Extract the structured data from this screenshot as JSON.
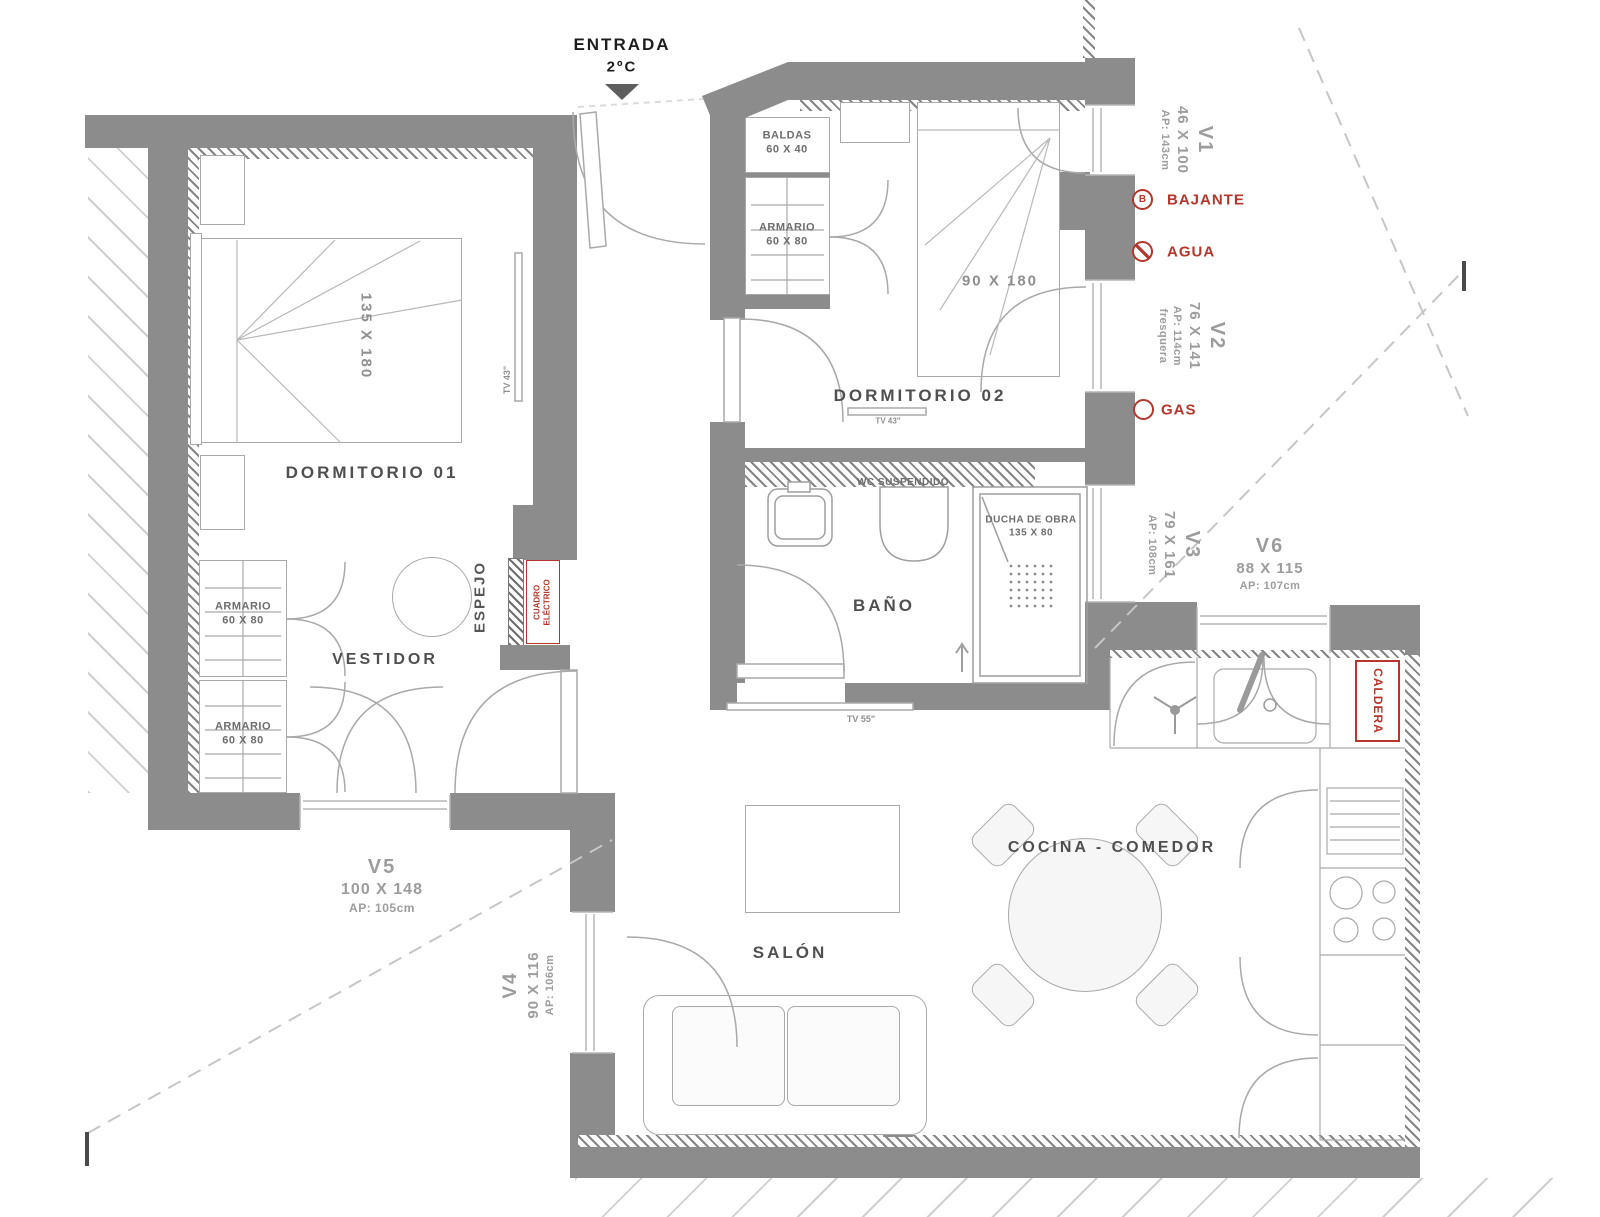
{
  "entrance": {
    "label": "ENTRADA",
    "temp": "2ºC"
  },
  "rooms": {
    "dorm1": {
      "name": "DORMITORIO 01",
      "bed": "135 X 180",
      "tv": "TV 43\""
    },
    "dorm2": {
      "name": "DORMITORIO 02",
      "bed": "90 X 180",
      "tv": "TV 43\"",
      "baldas": "BALDAS",
      "baldas_size": "60 X 40",
      "armario": "ARMARIO",
      "armario_size": "60 X 80"
    },
    "vestidor": {
      "name": "VESTIDOR",
      "armario": "ARMARIO",
      "armario_size": "60 X 80",
      "espejo": "ESPEJO"
    },
    "bano": {
      "name": "BAÑO",
      "wc": "WC SUSPENDIDO",
      "ducha": "DUCHA DE OBRA",
      "ducha_size": "135 X 80",
      "tv": "TV 55\""
    },
    "salon": {
      "name": "SALÓN"
    },
    "cocina": {
      "name": "COCINA - COMEDOR"
    }
  },
  "windows": {
    "v1": {
      "id": "V1",
      "size": "46 X 100",
      "ap": "AP: 143cm"
    },
    "v2": {
      "id": "V2",
      "size": "76 X 141",
      "ap": "AP: 114cm",
      "note": "fresquera"
    },
    "v3": {
      "id": "V3",
      "size": "79 X 161",
      "ap": "AP: 108cm"
    },
    "v4": {
      "id": "V4",
      "size": "90 X 116",
      "ap": "AP: 106cm"
    },
    "v5": {
      "id": "V5",
      "size": "100 X 148",
      "ap": "AP: 105cm"
    },
    "v6": {
      "id": "V6",
      "size": "88 X 115",
      "ap": "AP: 107cm"
    }
  },
  "installations": {
    "bajante": {
      "icon": "B",
      "label": "BAJANTE"
    },
    "agua": {
      "label": "AGUA"
    },
    "gas": {
      "label": "GAS"
    },
    "caldera": {
      "label": "CALDERA"
    },
    "cuadro": {
      "line1": "CUADRO",
      "line2": "ELÉCTRICO"
    }
  },
  "colors": {
    "wall": "#8c8c8c",
    "accent_red": "#b5362c",
    "line": "#a9a9a9",
    "text": "#4f4f4f",
    "text_muted": "#9c9c9c"
  }
}
